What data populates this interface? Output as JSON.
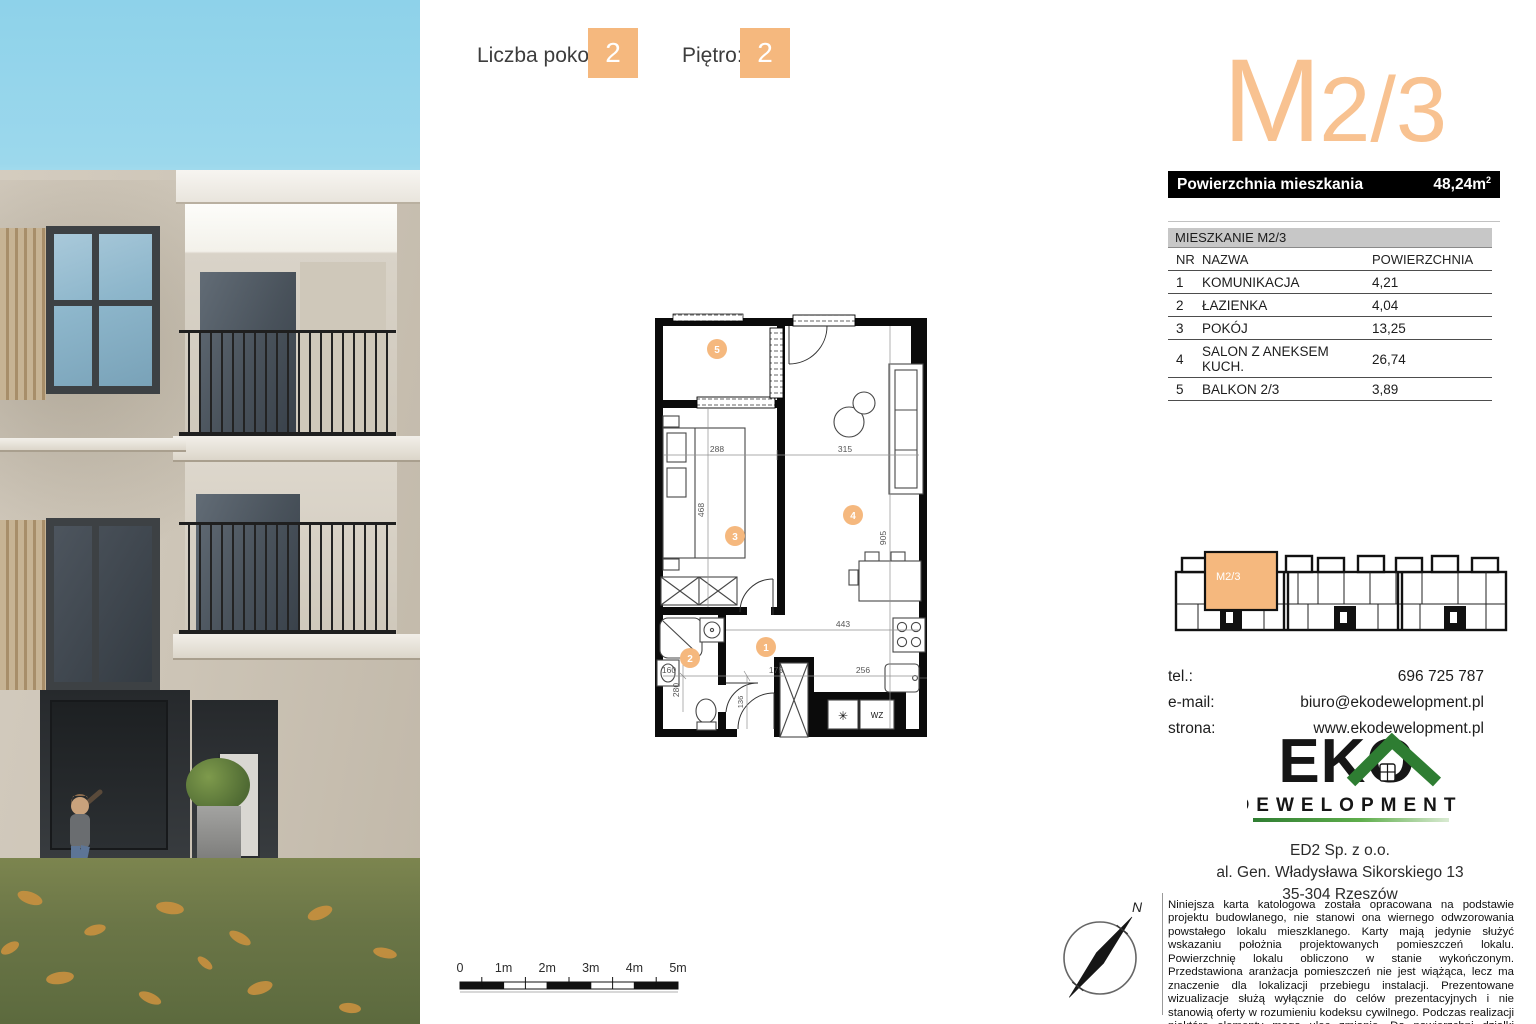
{
  "header": {
    "rooms_label": "Liczba pokoi:",
    "rooms_value": "2",
    "floor_label": "Piętro:",
    "floor_value": "2"
  },
  "title": {
    "prefix": "M",
    "suffix": "2/3"
  },
  "area_bar": {
    "label": "Powierzchnia mieszkania",
    "value": "48,24m",
    "superscript": "2"
  },
  "room_table": {
    "title": "MIESZKANIE M2/3",
    "columns": [
      "NR",
      "NAZWA",
      "POWIERZCHNIA"
    ],
    "rows": [
      {
        "nr": "1",
        "nazwa": "KOMUNIKACJA",
        "powierzchnia": "4,21"
      },
      {
        "nr": "2",
        "nazwa": "ŁAZIENKA",
        "powierzchnia": "4,04"
      },
      {
        "nr": "3",
        "nazwa": "POKÓJ",
        "powierzchnia": "13,25"
      },
      {
        "nr": "4",
        "nazwa": "SALON Z ANEKSEM KUCH.",
        "powierzchnia": "26,74"
      },
      {
        "nr": "5",
        "nazwa": "BALKON 2/3",
        "powierzchnia": "3,89"
      }
    ]
  },
  "floorplan": {
    "markers": {
      "m1": "1",
      "m2": "2",
      "m3": "3",
      "m4": "4",
      "m5": "5"
    },
    "dims": {
      "w288": "288",
      "w315": "315",
      "h468": "468",
      "h905": "905",
      "w443": "443",
      "w160": "160",
      "w175": "175",
      "w256": "256",
      "h280": "280",
      "h136": "136"
    },
    "labels": {
      "wz": "WZ",
      "boiler_symbol": "✳"
    }
  },
  "overview": {
    "unit_label": "M2/3"
  },
  "contact": {
    "rows": [
      {
        "label": "tel.:",
        "value": "696 725 787"
      },
      {
        "label": "e-mail:",
        "value": "biuro@ekodewelopment.pl"
      },
      {
        "label": "strona:",
        "value": "www.ekodewelopment.pl"
      }
    ]
  },
  "logo": {
    "word": "EKO",
    "subword": "DEWELOPMENT"
  },
  "address": {
    "lines": [
      "ED2 Sp. z o.o.",
      "al. Gen. Władysława Sikorskiego 13",
      "35-304 Rzeszów"
    ]
  },
  "disclaimer": "Niniejsza karta katologowa została opracowana na podstawie projektu budowlanego, nie stanowi ona wiernego odwzorowania powstałego lokalu mieszklanego. Karty mają jedynie służyć wskazaniu położnia projektowanych pomieszczeń lokalu. Powierzchnię lokalu obliczono w stanie wykończonym. Przedstawiona aranżacja pomieszczeń nie jest wiążąca, lecz ma znaczenie dla lokalizacji przebiegu instalacji. Prezentowane wizualizacje służą wyłącznie do celów prezentacyjnych i nie stanowią oferty w rozumieniu kodeksu cywilnego. Podczas realizacji niektóre elementy mogą ulec zmianie. Do powierzchni działki została wliczona powierzchnia tarasu.",
  "scalebar": {
    "labels": [
      "0",
      "1m",
      "2m",
      "3m",
      "4m",
      "5m"
    ]
  },
  "compass": {
    "north_label": "N"
  },
  "colors": {
    "accent": "#f5b87e",
    "title_orange": "#f8c291",
    "bar_bg": "#000000",
    "table_header_bg": "#c7c7c7",
    "logo_green": "#2e7d32"
  }
}
